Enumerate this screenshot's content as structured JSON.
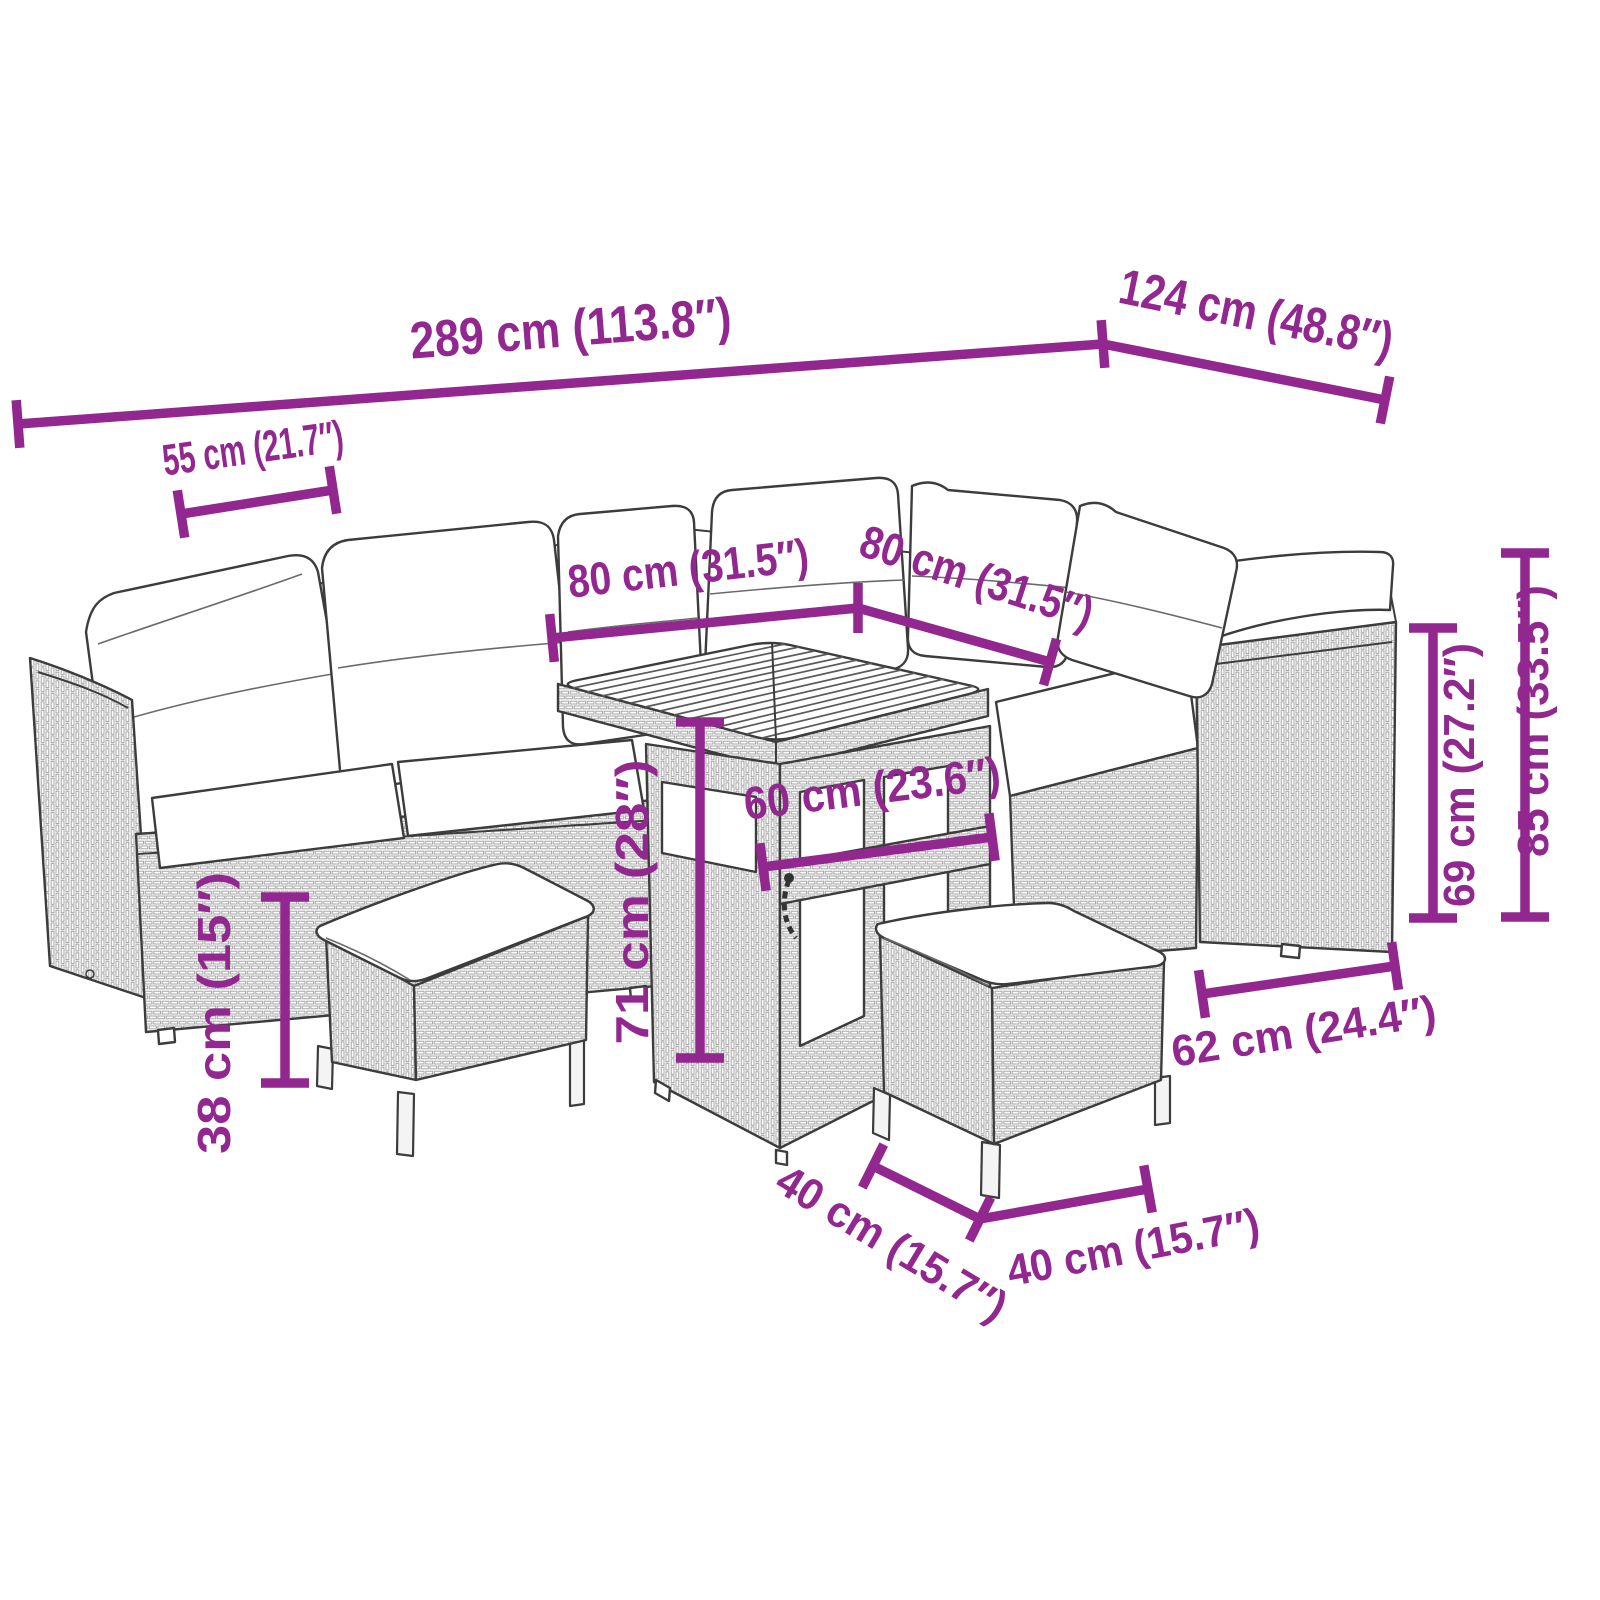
{
  "meta": {
    "type": "product-dimension-diagram",
    "subject": "poly-rattan-garden-lounge-set-with-table-and-stools",
    "style": "black-line-art-with-purple-dimension-annotations"
  },
  "colors": {
    "dimension_accent": "#92278f",
    "line_art": "#3c3c3c",
    "background": "#ffffff",
    "cushion_fill": "#ffffff"
  },
  "dimensions": {
    "overall_width": {
      "label": "289 cm (113.8″)",
      "cm": 289,
      "inches": 113.8
    },
    "overall_depth": {
      "label": "124 cm (48.8″)",
      "cm": 124,
      "inches": 48.8
    },
    "seat_width": {
      "label": "55 cm (21.7″)",
      "cm": 55,
      "inches": 21.7
    },
    "table_length": {
      "label": "80 cm (31.5″)",
      "cm": 80,
      "inches": 31.5
    },
    "table_width": {
      "label": "80 cm (31.5″)",
      "cm": 80,
      "inches": 31.5
    },
    "table_base_width": {
      "label": "60 cm (23.6″)",
      "cm": 60,
      "inches": 23.6
    },
    "table_height": {
      "label": "71 cm (28″)",
      "cm": 71,
      "inches": 28
    },
    "side_height": {
      "label": "69 cm (27.2″)",
      "cm": 69,
      "inches": 27.2
    },
    "total_height": {
      "label": "85 cm (33.5″)",
      "cm": 85,
      "inches": 33.5
    },
    "seat_depth": {
      "label": "62 cm (24.4″)",
      "cm": 62,
      "inches": 24.4
    },
    "stool_height": {
      "label": "38 cm (15″)",
      "cm": 38,
      "inches": 15
    },
    "stool_width": {
      "label": "40 cm (15.7″)",
      "cm": 40,
      "inches": 15.7
    },
    "stool_depth": {
      "label": "40 cm (15.7″)",
      "cm": 40,
      "inches": 15.7
    }
  }
}
